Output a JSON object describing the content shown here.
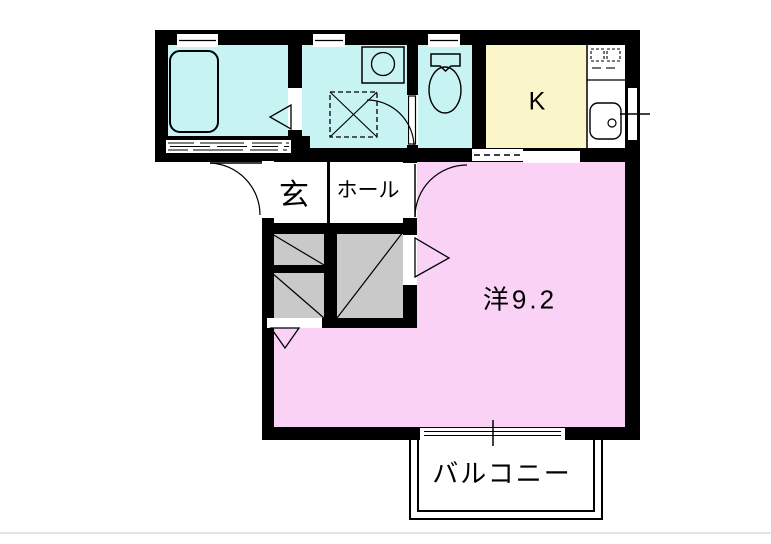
{
  "floor_plan": {
    "labels": {
      "kitchen": "K",
      "entrance": "玄",
      "hall": "ホール",
      "main_room": "洋9.2",
      "balcony": "バルコニー"
    },
    "colors": {
      "wet_area": "#c8f3f3",
      "kitchen_floor": "#fbf6c9",
      "main_room_floor": "#f9d2f5",
      "closet": "#c9c9c9",
      "wall": "#000000",
      "background": "#ffffff"
    }
  }
}
